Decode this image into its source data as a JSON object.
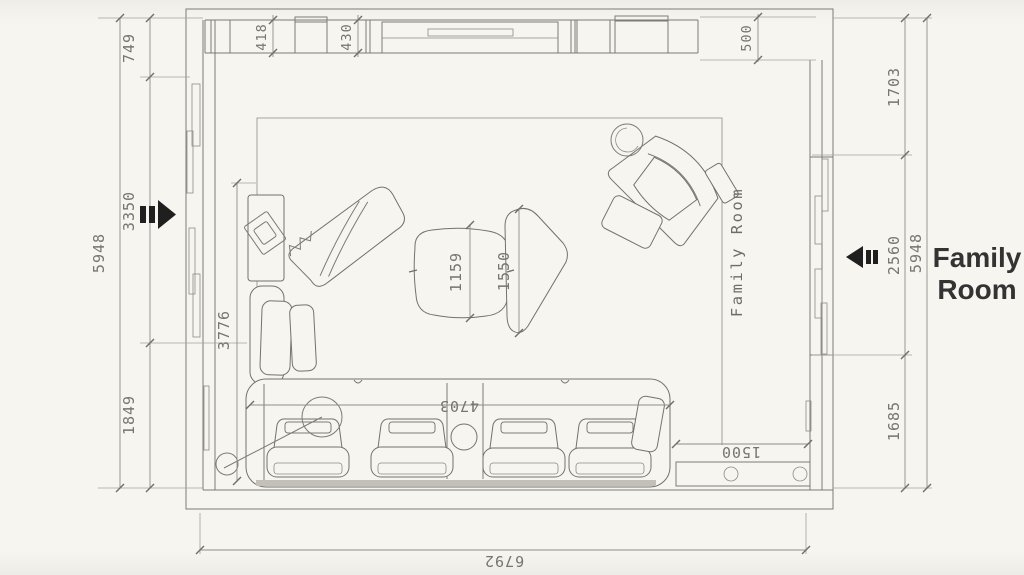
{
  "labels": {
    "room_side": "Family Room",
    "room_interior": "Family Room"
  },
  "dims": {
    "left": {
      "total": "5948",
      "chain": [
        "749",
        "3350",
        "1849"
      ]
    },
    "right": {
      "total": "5948",
      "chain": [
        "1703",
        "2560",
        "1685"
      ]
    },
    "top": {
      "cabinet_a": "418",
      "cabinet_b": "430",
      "recess": "500"
    },
    "bottom": {
      "total": "6792"
    },
    "interior": {
      "left_depth": "3776",
      "table_small": "1159",
      "table_large": "1550",
      "sofa_length": "4703",
      "console": "1500"
    }
  },
  "colors": {
    "paper": "#f6f5f0",
    "line": "#7c7b75",
    "dim_text": "#76756f",
    "label": "#333333",
    "arrow": "#1f1f1f"
  }
}
